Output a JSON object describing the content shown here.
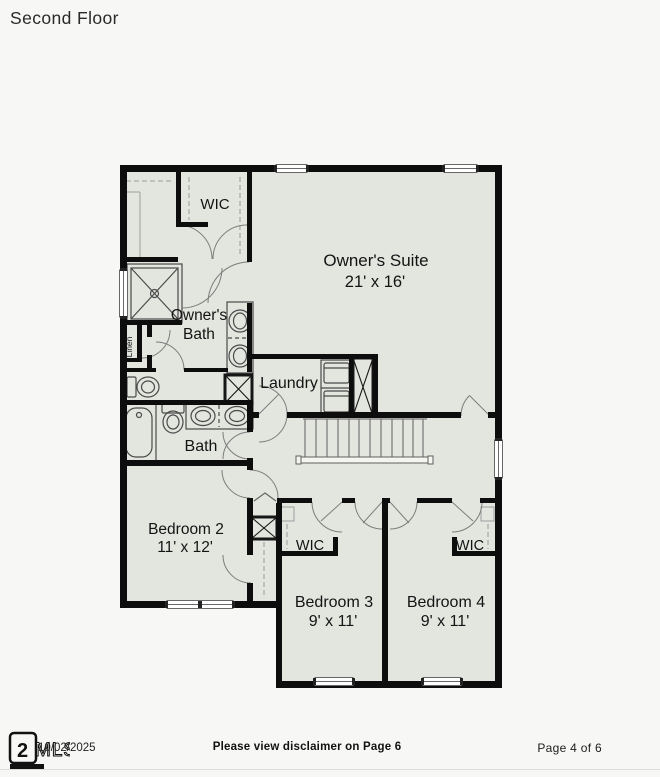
{
  "title": "Second Floor",
  "plan": {
    "wic_upper_label": "WIC",
    "owners_suite_name": "Owner's Suite",
    "owners_suite_dims": "21' x 16'",
    "owners_bath_line1": "Owner's",
    "owners_bath_line2": "Bath",
    "linen_label": "Linen",
    "laundry_label": "Laundry",
    "bath_label": "Bath",
    "bedroom2_name": "Bedroom 2",
    "bedroom2_dims": "11' x 12'",
    "bedroom3_name": "Bedroom 3",
    "bedroom3_dims": "9' x 11'",
    "bedroom4_name": "Bedroom 4",
    "bedroom4_dims": "9' x 11'",
    "wic_bed3_label": "WIC",
    "wic_bed4_label": "WIC",
    "colors": {
      "floor_fill": "#e3e5df",
      "wall": "#0d0d0d",
      "fixture_line": "#4a4a4a"
    }
  },
  "footer": {
    "logo_text": "MLS",
    "date": "10/02/2025",
    "disclaimer": "Please view disclaimer on Page 6",
    "page_indicator": "Page 4 of 6"
  }
}
